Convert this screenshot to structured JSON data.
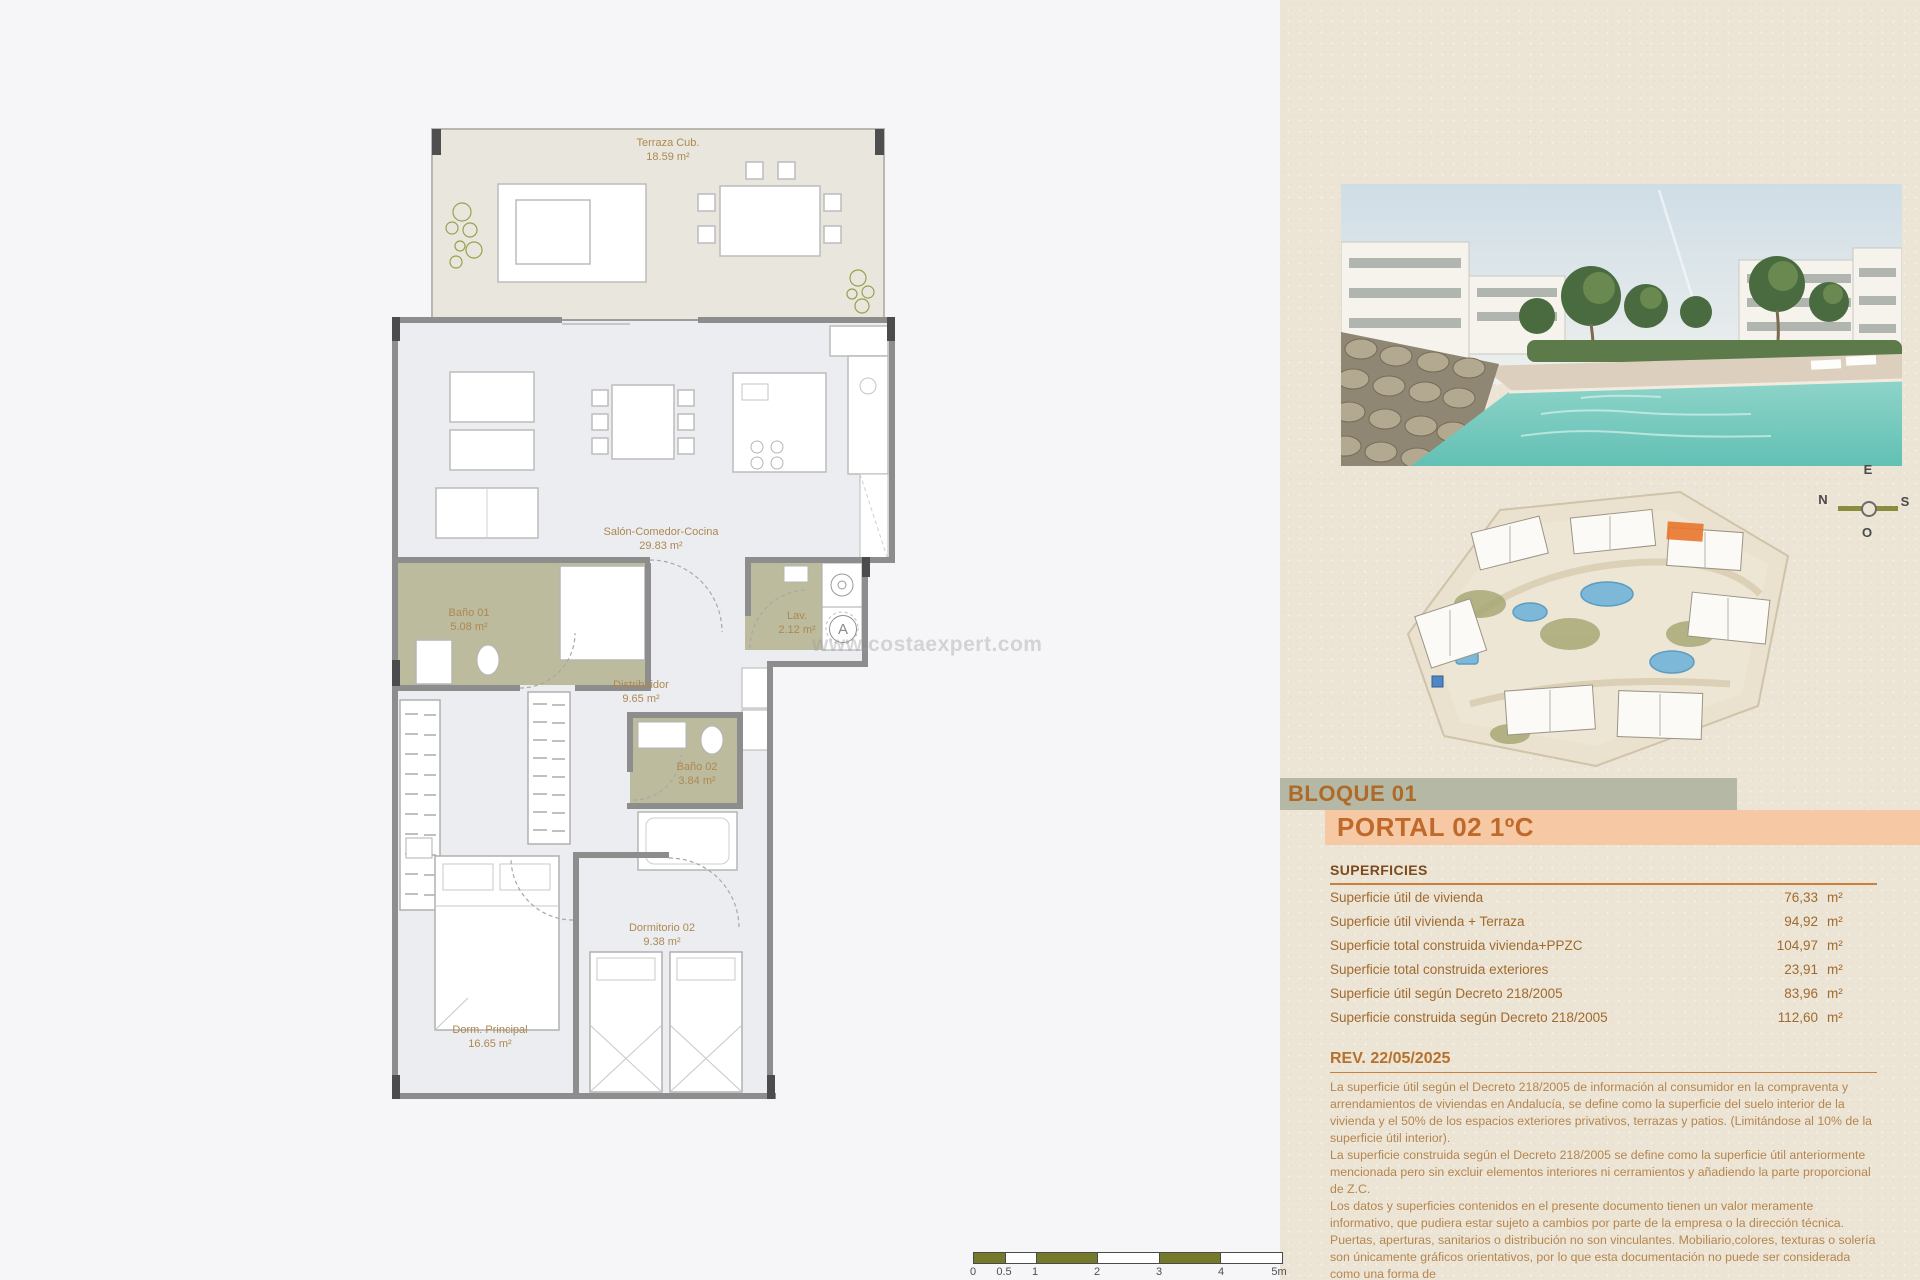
{
  "plan": {
    "rooms": [
      {
        "name": "Terraza Cub.",
        "area": "18.59 m²"
      },
      {
        "name": "Salón-Comedor-Cocina",
        "area": "29.83 m²"
      },
      {
        "name": "Baño 01",
        "area": "5.08 m²"
      },
      {
        "name": "Lav.",
        "area": "2.12 m²"
      },
      {
        "name": "Distribuidor",
        "area": "9.65 m²"
      },
      {
        "name": "Baño 02",
        "area": "3.84 m²"
      },
      {
        "name": "Dormitorio 02",
        "area": "9.38 m²"
      },
      {
        "name": "Dorm. Principal",
        "area": "16.65 m²"
      }
    ],
    "hatch_marker": "A",
    "watermark": "www.costaexpert.com",
    "scale_bar": {
      "labels": [
        "0",
        "0.5",
        "1",
        "2",
        "3",
        "4",
        "5m"
      ]
    }
  },
  "panel": {
    "compass": {
      "top": "E",
      "left": "N",
      "right": "S",
      "bottom": "O"
    },
    "bloque_label": "BLOQUE 01",
    "portal_label": "PORTAL 02 1ºC",
    "superficies": {
      "title": "SUPERFICIES",
      "rows": [
        {
          "label": "Superficie útil de vivienda",
          "value": "76,33",
          "unit": "m²"
        },
        {
          "label": "Superficie útil vivienda + Terraza",
          "value": "94,92",
          "unit": "m²"
        },
        {
          "label": "Superficie total construida vivienda+PPZC",
          "value": "104,97",
          "unit": "m²"
        },
        {
          "label": "Superficie total construida exteriores",
          "value": "23,91",
          "unit": "m²"
        },
        {
          "label": "Superficie útil según Decreto 218/2005",
          "value": "83,96",
          "unit": "m²"
        },
        {
          "label": "Superficie construida según Decreto 218/2005",
          "value": "112,60",
          "unit": "m²"
        }
      ]
    },
    "revision": {
      "title": "REV. 22/05/2025",
      "paragraphs": [
        "La superficie útil según el Decreto 218/2005 de información al consumidor en la compraventa y arrendamientos de viviendas en Andalucía, se define como la superficie del suelo interior de la vivienda y el 50% de los espacios exteriores privativos, terrazas y patios. (Limitándose al 10% de la superficie útil interior).",
        "La superficie construida según el Decreto 218/2005 se define como la superficie útil anteriormente mencionada pero sin excluir elementos interiores ni cerramientos y añadiendo la parte proporcional de Z.C.",
        "Los datos y superficies contenidos en el presente documento tienen un valor meramente informativo, que pudiera estar sujeto a cambios por parte de la empresa o la dirección técnica. Puertas, aperturas, sanitarios o distribución no son vinculantes. Mobiliario,colores, texturas o solería son únicamente gráficos orientativos, por lo que esta documentación no puede ser considerada como una forma de"
      ]
    }
  },
  "colors": {
    "accent_orange": "#bf6a2a",
    "band_sage": "#b5b8a5",
    "band_peach": "#f6c8a4",
    "room_olive": "#bcbb9d",
    "pool_teal": "#7ecfc4",
    "scale_olive": "#75792b"
  }
}
